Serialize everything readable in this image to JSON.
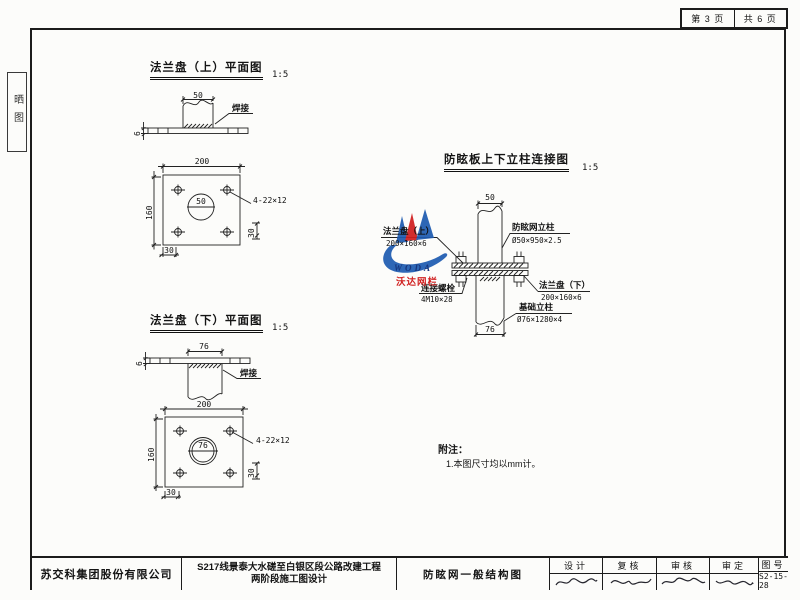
{
  "frame": {
    "page_no": "第 3 页",
    "pages_total": "共 6 页",
    "side_tab": "晒图"
  },
  "upper_flange": {
    "title": "法兰盘（上）平面图",
    "scale": "1:5",
    "elev_pipe_dim": "50",
    "elev_weld": "焊接",
    "elev_thickness": "6",
    "plan_width": "200",
    "plan_height": "160",
    "pipe_dia": "50",
    "holes": "4-22×12",
    "offset_bottom": "30",
    "offset_side": "30"
  },
  "lower_flange": {
    "title": "法兰盘（下）平面图",
    "scale": "1:5",
    "elev_pipe_dim": "76",
    "elev_weld": "焊接",
    "elev_thickness": "6",
    "plan_width": "200",
    "plan_height": "160",
    "pipe_dia": "76",
    "holes": "4-22×12",
    "offset_bottom": "30",
    "offset_side": "30"
  },
  "connection": {
    "title": "防眩板上下立柱连接图",
    "scale": "1:5",
    "top_dim": "50",
    "bottom_dim": "76",
    "upper_post_name": "防眩网立柱",
    "upper_post_spec": "Ø50×950×2.5",
    "upper_flange_name": "法兰盘（上）",
    "upper_flange_spec": "200×160×6",
    "bolt_name": "连接螺栓",
    "bolt_spec": "4M10×28",
    "lower_flange_name": "法兰盘（下）",
    "lower_flange_spec": "200×160×6",
    "base_post_name": "基础立柱",
    "base_post_spec": "Ø76×1280×4"
  },
  "logo": {
    "latin": "WODA",
    "chinese": "沃达网栏",
    "blue": "#1e5bb0",
    "red": "#d01f1f"
  },
  "notes": {
    "heading": "附注：",
    "item1": "1.本图尺寸均以mm计。"
  },
  "titleblock": {
    "company": "苏交科集团股份有限公司",
    "project_line1": "S217线景泰大水磋至白银区段公路改建工程",
    "project_line2": "两阶段施工图设计",
    "drawing_name": "防眩网一般结构图",
    "col_design": "设计",
    "col_recheck": "复核",
    "col_review": "审核",
    "col_approve": "审定",
    "col_no": "图号",
    "drawing_no": "S2-15-28"
  }
}
